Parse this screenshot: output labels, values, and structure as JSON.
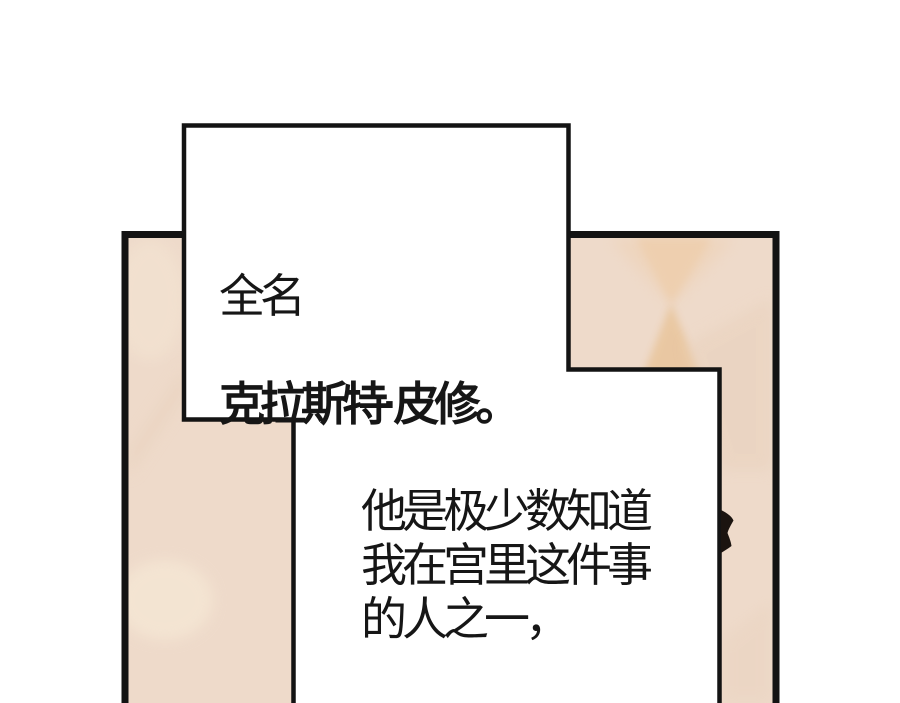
{
  "page": {
    "background_color": "#ffffff"
  },
  "colors": {
    "panel_base": "#eedaca",
    "panel_border": "#131313",
    "bubble_fill": "#ffffff",
    "bubble_border": "#131313",
    "pattern_top_triangle": "#eecfae",
    "pattern_bottom_triangle": "#e9c69e",
    "pattern_soft_dark": "#e8d0bb",
    "pattern_soft_light": "#f7ead7",
    "hair_spike": "#1b1410",
    "text": "#161616"
  },
  "speech_bubble": {
    "name_label": "全名",
    "name_value": "克拉斯特·皮修。"
  },
  "monologue": {
    "text": "他是极少数知道\n我在宫里这件事\n的人之一，"
  }
}
